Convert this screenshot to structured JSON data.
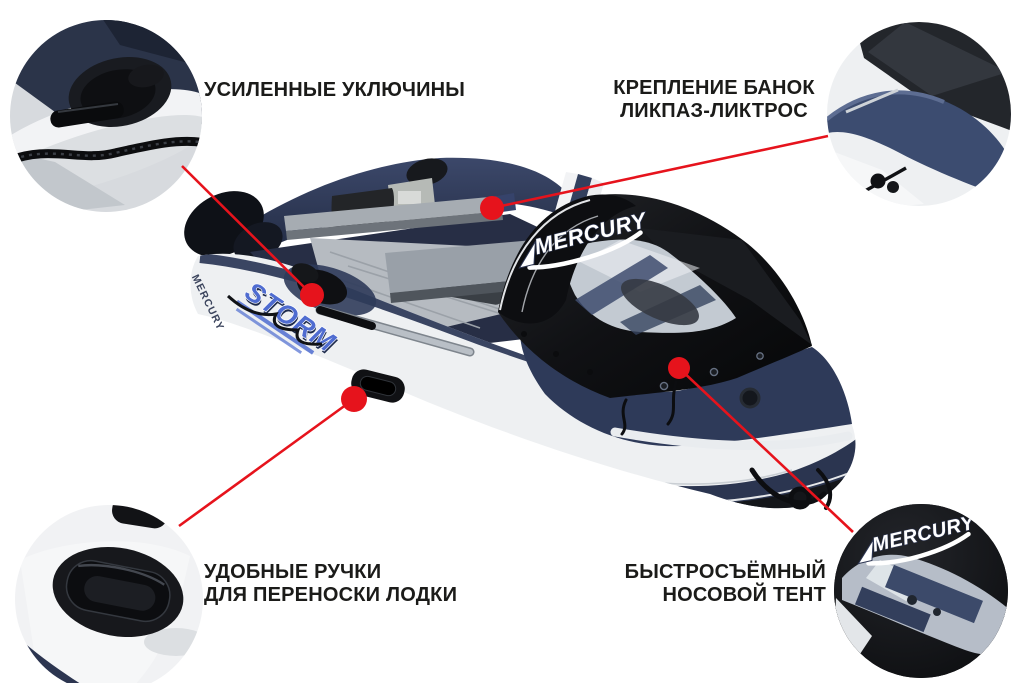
{
  "page": {
    "background": "#ffffff"
  },
  "colors": {
    "accent_red": "#e6131c",
    "boat_navy": "#2b3550",
    "tent_black": "#0e0f12",
    "hull_white": "#eef0f2",
    "label_text": "#1b1b19",
    "storm_blue": "#4f6cd0"
  },
  "brand": {
    "mercury": "MERCURY",
    "storm": "STORM"
  },
  "callouts": {
    "oarlocks": {
      "line1": "УСИЛЕННЫЕ УКЛЮЧИНЫ"
    },
    "seat_mount": {
      "line1": "КРЕПЛЕНИЕ БАНОК",
      "line2": "ЛИКПАЗ-ЛИКТРОС"
    },
    "handles": {
      "line1": "УДОБНЫЕ РУЧКИ",
      "line2": "ДЛЯ ПЕРЕНОСКИ ЛОДКИ"
    },
    "bow_tent": {
      "line1": "БЫСТРОСЪЁМНЫЙ",
      "line2": "НОСОВОЙ ТЕНТ"
    }
  }
}
